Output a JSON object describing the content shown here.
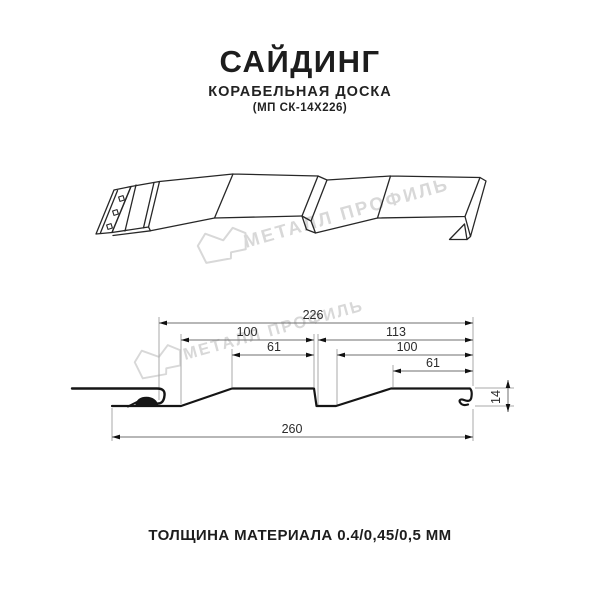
{
  "header": {
    "title": "САЙДИНГ",
    "subtitle": "КОРАБЕЛЬНАЯ ДОСКА",
    "model": "(МП СК-14Х226)"
  },
  "watermark": {
    "brand": "МЕТАЛЛ ПРОФИЛЬ",
    "color": "#d8d8d8"
  },
  "drawing": {
    "views": {
      "perspective": "siding panel 3d line drawing",
      "cross_section": "siding panel profile section with dimensions"
    },
    "dims": {
      "width_total_top": "226",
      "pitch_left": "100",
      "pitch_right": "113",
      "crest_left": "61",
      "inner_right": "100",
      "crest_right": "61",
      "width_overall": "260",
      "height": "14"
    }
  },
  "footer": {
    "thickness": "ТОЛЩИНА МАТЕРИАЛА 0.4/0,45/0,5 ММ"
  },
  "colors": {
    "drawing_line": "#1c1c1c",
    "thin_line": "#a8a8a8",
    "dimension_text": "#2b2b2b",
    "watermark": "#d8d8d8"
  }
}
